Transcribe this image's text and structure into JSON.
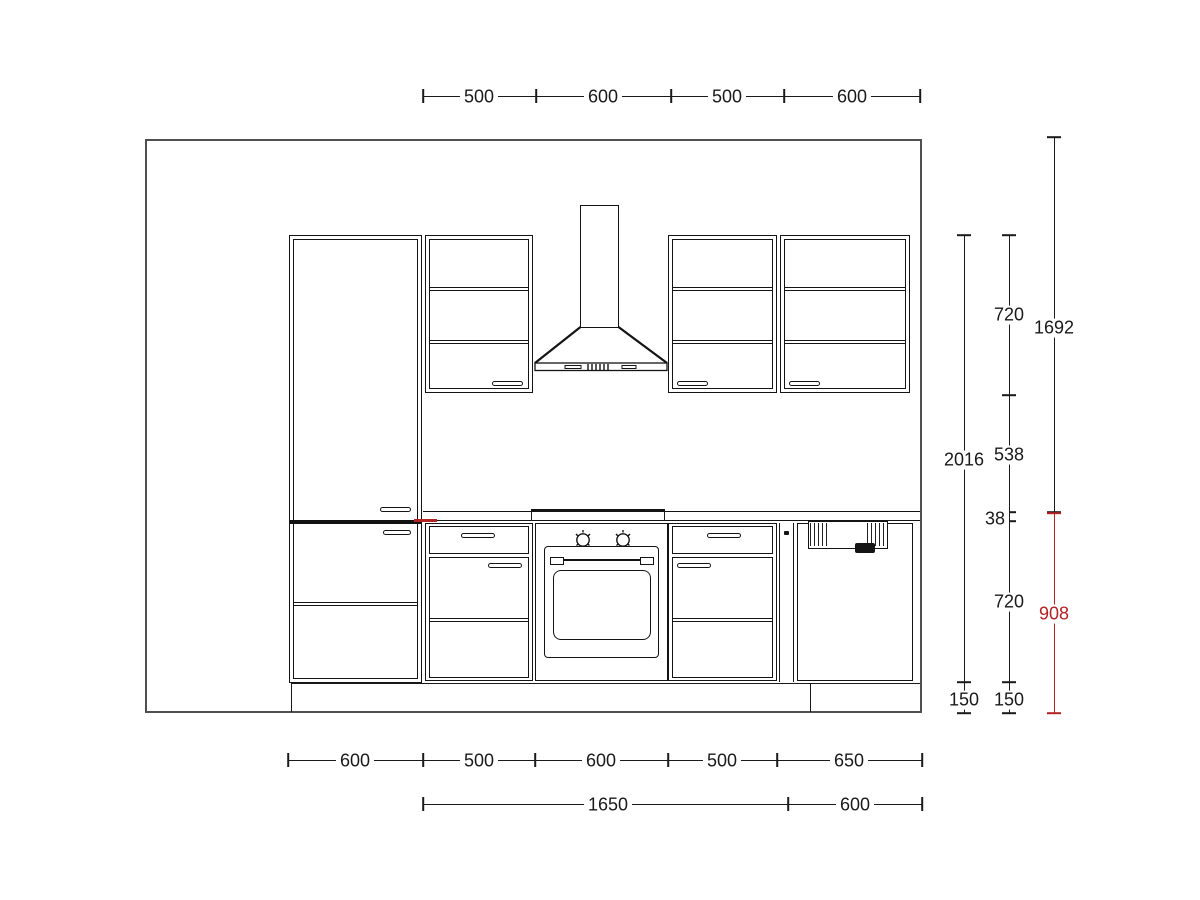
{
  "drawing": {
    "kind": "kitchen-elevation-plan",
    "colors": {
      "line": "#1a1a1a",
      "wall": "#4f4f4f",
      "accent_red": "#b22222"
    }
  },
  "dims": {
    "top": [
      "500",
      "600",
      "500",
      "600"
    ],
    "bottom_run": [
      "600",
      "500",
      "600",
      "500",
      "650"
    ],
    "bottom_totals": [
      "1650",
      "600"
    ],
    "right_a": [
      "2016",
      "150"
    ],
    "right_b": [
      "720",
      "538",
      "38",
      "720",
      "150"
    ],
    "right_c_black": "1692",
    "right_c_red": "908"
  }
}
